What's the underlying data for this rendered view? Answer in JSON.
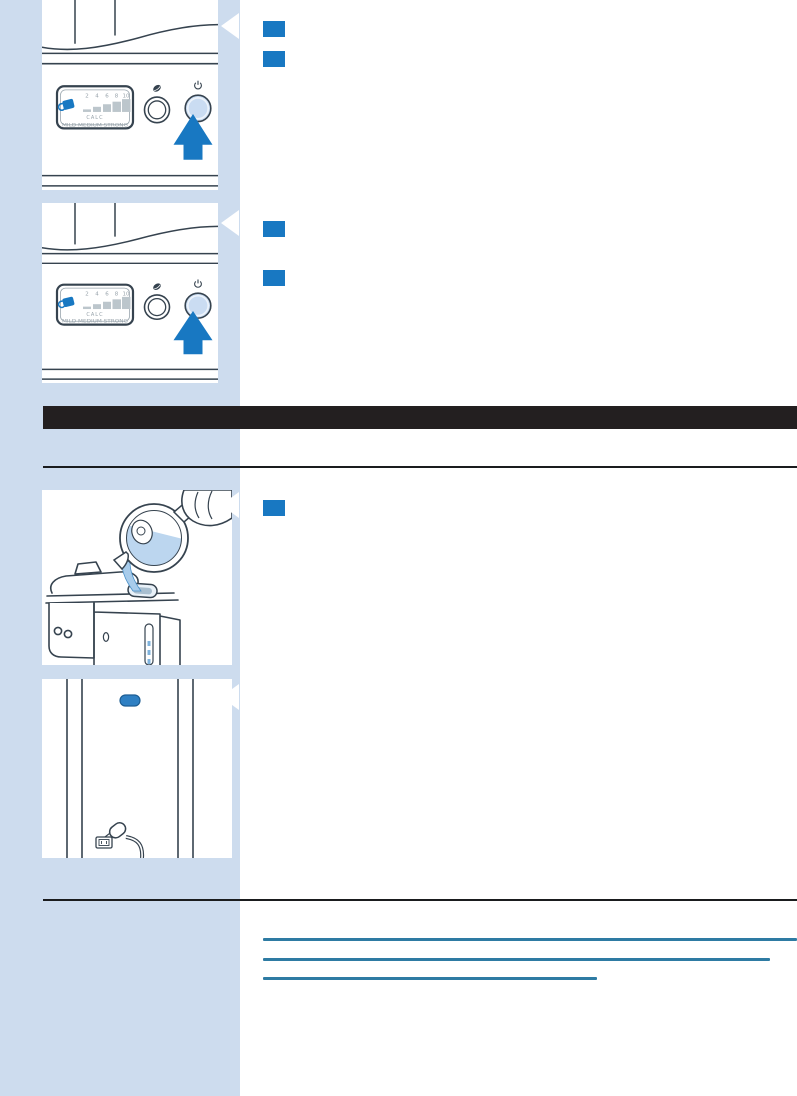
{
  "document": {
    "type": "appliance-manual-page",
    "section_header": {
      "label": "",
      "background": "#231f20"
    },
    "panel_display": {
      "ticks": [
        "2",
        "4",
        "6",
        "8",
        "10"
      ],
      "calc_label": "CALC",
      "strength_label": "MILD MEDIUM STRONG"
    },
    "figures": [
      {
        "name": "control-panel-press-power-1"
      },
      {
        "name": "control-panel-press-power-2"
      },
      {
        "name": "pour-water-into-reservoir"
      },
      {
        "name": "machine-front-indicator-and-cord"
      }
    ],
    "step_badges": {
      "count": 5,
      "color": "#1878c2"
    },
    "links": {
      "color": "#2e7ba3",
      "items": [
        {
          "label": ""
        },
        {
          "label": ""
        },
        {
          "label": ""
        }
      ]
    },
    "colors": {
      "sidebar": "#cddcee",
      "accent_blue": "#1878c2",
      "link_teal": "#2e7ba3",
      "header_black": "#231f20",
      "line_art": "#36434f",
      "button_fill": "#cadcf2",
      "water_blue": "#bcd6ef"
    }
  }
}
